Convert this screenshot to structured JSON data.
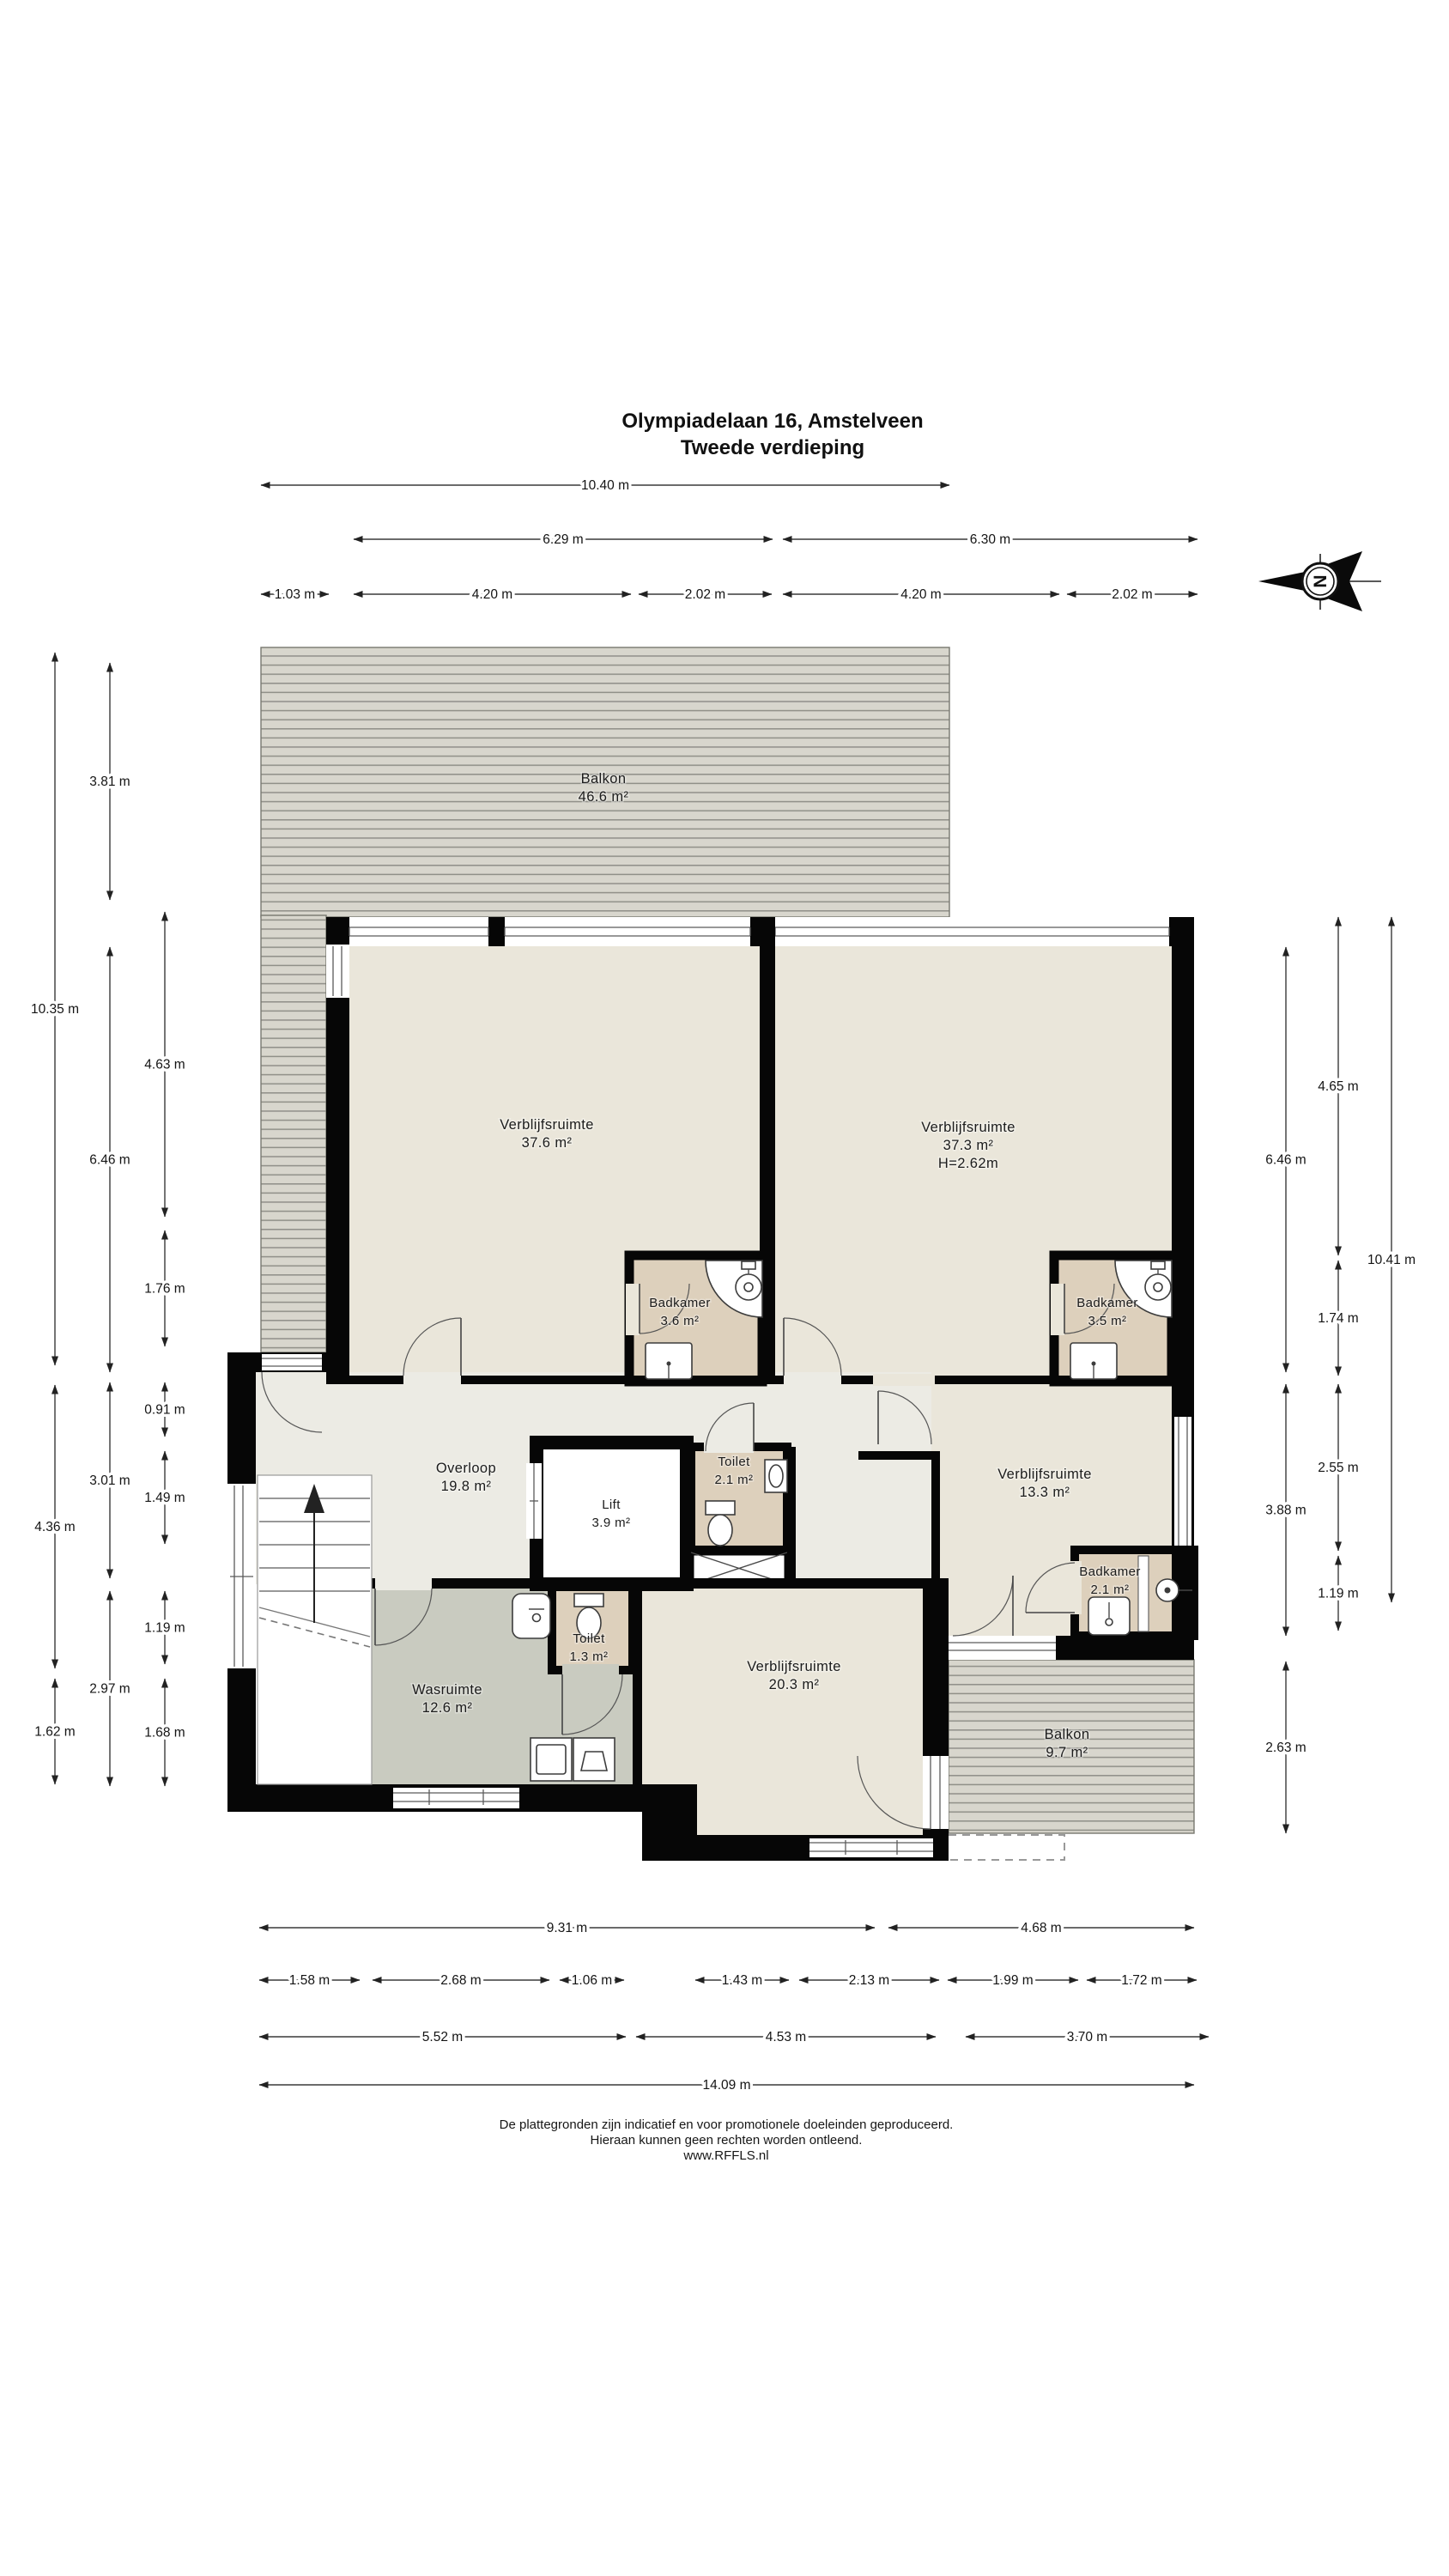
{
  "title": {
    "line1": "Olympiadelaan 16, Amstelveen",
    "line2": "Tweede verdieping"
  },
  "compass": {
    "letter": "N"
  },
  "rooms": [
    {
      "name": "Balkon",
      "area": "46.6 m²"
    },
    {
      "name": "Verblijfsruimte",
      "area": "37.6 m²"
    },
    {
      "name": "Verblijfsruimte",
      "area": "37.3 m²",
      "height": "H=2.62m"
    },
    {
      "name": "Badkamer",
      "area": "3.6 m²"
    },
    {
      "name": "Badkamer",
      "area": "3.5 m²"
    },
    {
      "name": "Overloop",
      "area": "19.8 m²"
    },
    {
      "name": "Lift",
      "area": "3.9 m²"
    },
    {
      "name": "Toilet",
      "area": "2.1 m²"
    },
    {
      "name": "Verblijfsruimte",
      "area": "13.3 m²"
    },
    {
      "name": "Badkamer",
      "area": "2.1 m²"
    },
    {
      "name": "Toilet",
      "area": "1.3 m²"
    },
    {
      "name": "Wasruimte",
      "area": "12.6 m²"
    },
    {
      "name": "Verblijfsruimte",
      "area": "20.3 m²"
    },
    {
      "name": "Balkon",
      "area": "9.7 m²"
    }
  ],
  "dimensions": {
    "top": [
      "10.40 m",
      "6.29 m",
      "6.30 m",
      "1.03 m",
      "4.20 m",
      "2.02 m",
      "4.20 m",
      "2.02 m"
    ],
    "left": [
      "10.35 m",
      "4.36 m",
      "1.62 m",
      "3.81 m",
      "6.46 m",
      "3.01 m",
      "2.97 m",
      "4.63 m",
      "1.76 m",
      "0.91 m",
      "1.49 m",
      "1.19 m",
      "1.68 m"
    ],
    "right": [
      "6.46 m",
      "3.88 m",
      "2.63 m",
      "4.65 m",
      "1.74 m",
      "2.55 m",
      "1.19 m",
      "10.41 m"
    ],
    "bottom": [
      "9.31 m",
      "4.68 m",
      "1.58 m",
      "2.68 m",
      "1.06 m",
      "1.43 m",
      "2.13 m",
      "1.99 m",
      "1.72 m",
      "5.52 m",
      "4.53 m",
      "3.70 m",
      "14.09 m"
    ]
  },
  "footer": {
    "line1": "De plattegronden zijn indicatief en voor promotionele doeleinden geproduceerd.",
    "line2": "Hieraan kunnen geen rechten worden ontleend.",
    "line3": "www.RFFLS.nl"
  },
  "colors": {
    "room_cream": "#eae6da",
    "hall_gray": "#ecebe4",
    "bath_tan": "#ddd0bc",
    "laundry_gray": "#c9cbc0",
    "deck": "#d8d6cd",
    "deck_line": "#8f8f88",
    "wall": "#060606"
  }
}
